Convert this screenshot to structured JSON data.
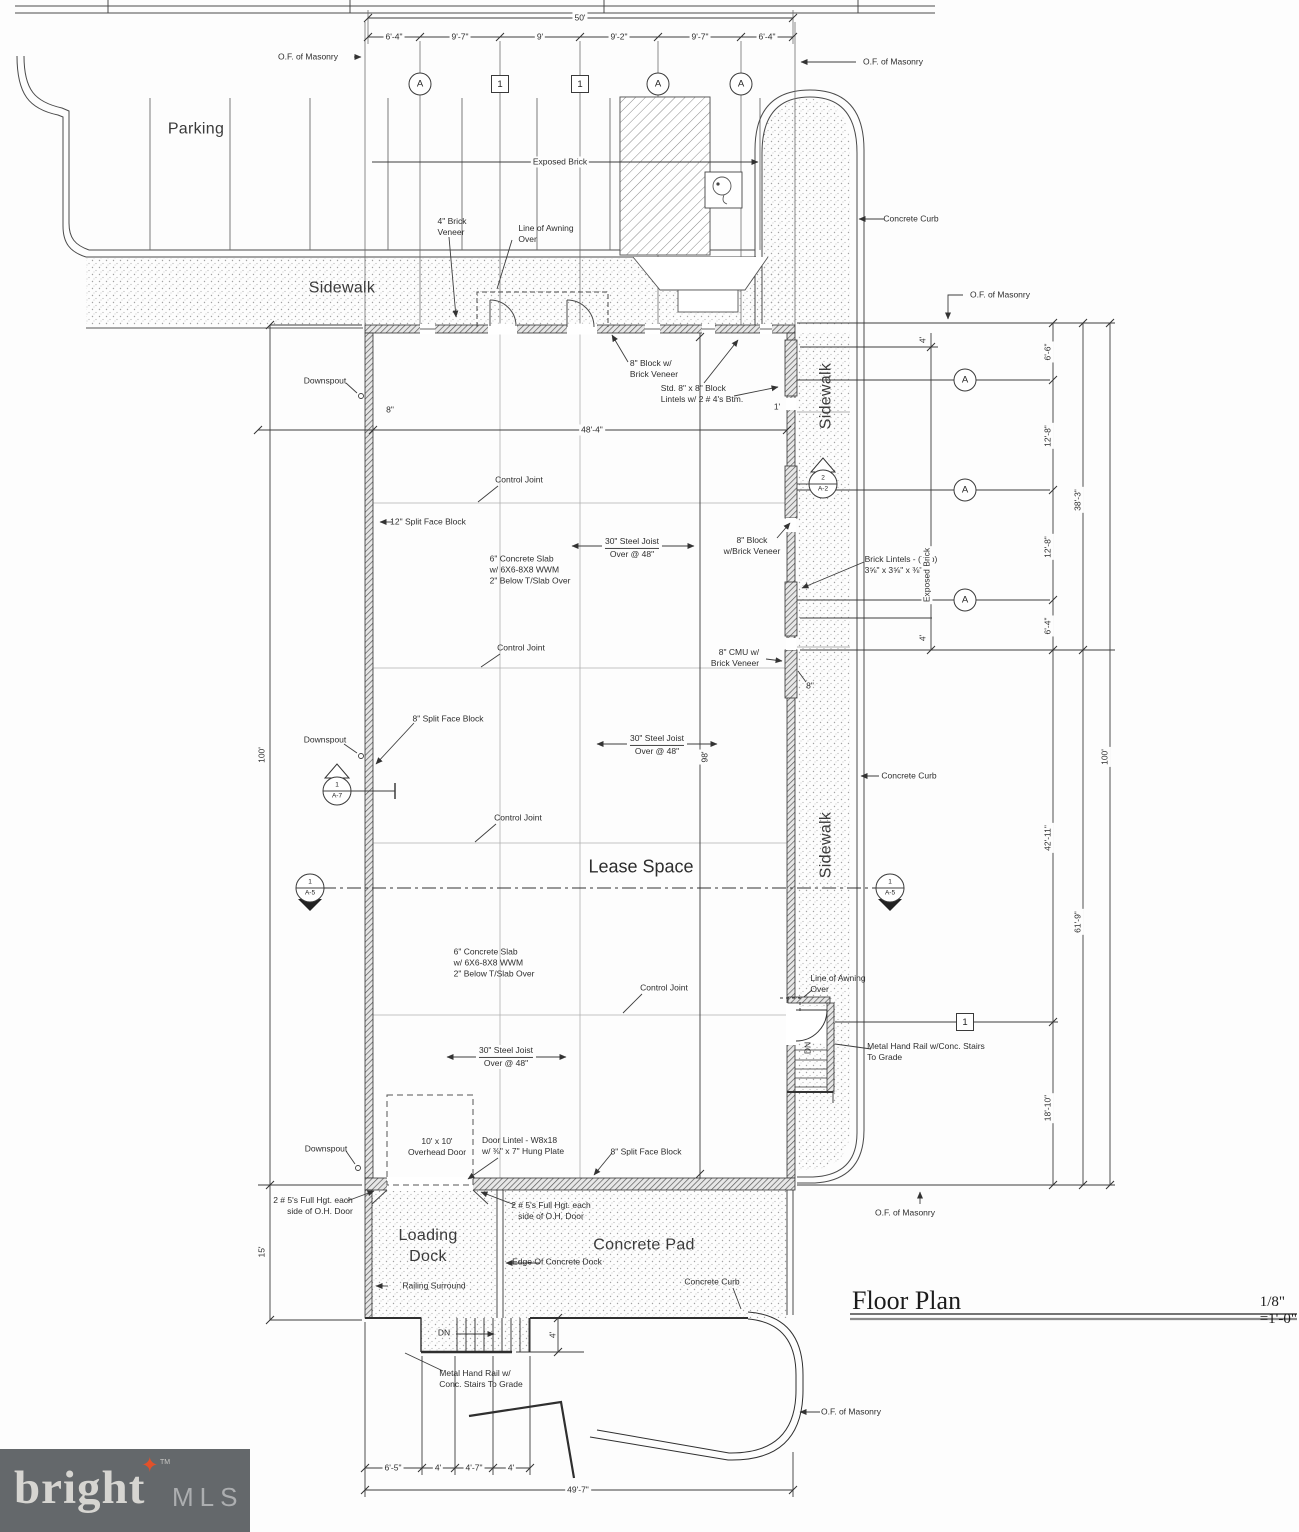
{
  "title_block": {
    "title": "Floor Plan",
    "scale": "1/8\" =1'-0\""
  },
  "areas": {
    "parking": "Parking",
    "sidewalk": "Sidewalk",
    "lease": "Lease Space",
    "loading_dock": "Loading\nDock",
    "concrete_pad": "Concrete Pad"
  },
  "grid": {
    "top": [
      "A",
      "1",
      "1",
      "A",
      "A"
    ],
    "side": [
      "A",
      "A",
      "A"
    ],
    "detail": "1"
  },
  "sections": {
    "a7": {
      "num": "1",
      "sheet": "A-7"
    },
    "a2": {
      "num": "2",
      "sheet": "A-2"
    },
    "a5_left": {
      "num": "1",
      "sheet": "A-5"
    },
    "a5_right": {
      "num": "1",
      "sheet": "A-5"
    }
  },
  "dims": {
    "top": {
      "overall": "50'",
      "segments": [
        "6'-4\"",
        "9'-7\"",
        "9'",
        "9'-2\"",
        "9'-7\"",
        "6'-4\""
      ]
    },
    "left": {
      "building": "100'",
      "dock": "15'"
    },
    "right": {
      "overall": "100'",
      "upper": [
        "6'-6\"",
        "12'-8\"",
        "12'-8\"",
        "6'-4\""
      ],
      "upper_total": "38'-3\"",
      "lower": [
        "42'-11\"",
        "18'-10\""
      ],
      "lower_total": "61'-9\"",
      "sidewalk": "4'"
    },
    "bottom": {
      "overall": "49'-7\"",
      "segments": [
        "6'-5\"",
        "4'",
        "4'-7\"",
        "4'"
      ],
      "stair_depth": "4'"
    },
    "interior": {
      "width": "48'-4\"",
      "depth": "98'",
      "wall_left": "8\"",
      "wall_right": "8\"",
      "offset": "1'"
    }
  },
  "notes": {
    "of_masonry": "O.F. of Masonry",
    "downspout": "Downspout",
    "control_joint": "Control Joint",
    "concrete_curb": "Concrete Curb",
    "exposed_brick": "Exposed Brick",
    "brick_veneer_4": "4\" Brick\nVeneer",
    "awning": "Line of Awning\nOver",
    "block8_top": "8\" Block w/\nBrick Veneer",
    "std_lintels": "Std. 8\" x 8\" Block\nLintels w/ 2 # 4's Btm.",
    "split_face_12": "12\" Split Face Block",
    "split_face_8": "8\" Split Face Block",
    "slab": "6\" Concrete Slab\nw/ 6X6-8X8 WWM\n2\" Below T/Slab Over",
    "steel_joist_top": "30\" Steel Joist",
    "steel_joist_bottom": "Over @ 48\"",
    "block8_right": "8\" Block\nw/Brick Veneer",
    "brick_lintels": "Brick Lintels - (Typ)\n3⅝\" x 3⅝\" x ⅜\"",
    "cmu8": "8\" CMU w/\nBrick Veneer",
    "handrail_right": "Metal Hand Rail w/Conc. Stairs\nTo Grade",
    "handrail_bottom": "Metal Hand Rail w/\nConc. Stairs To Grade",
    "overhead_door": "10' x 10'\nOverhead Door",
    "door_lintel": "Door Lintel - W8x18\nw/ ⅜\" x 7\" Hung Plate",
    "rebar": "2 # 5's Full Hgt. each\nside of O.H. Door",
    "edge_dock": "Edge Of Concrete Dock",
    "railing": "Railing Surround",
    "dn": "DN"
  },
  "logo": {
    "brand": "bright",
    "tm": "TM",
    "suffix": "MLS"
  }
}
